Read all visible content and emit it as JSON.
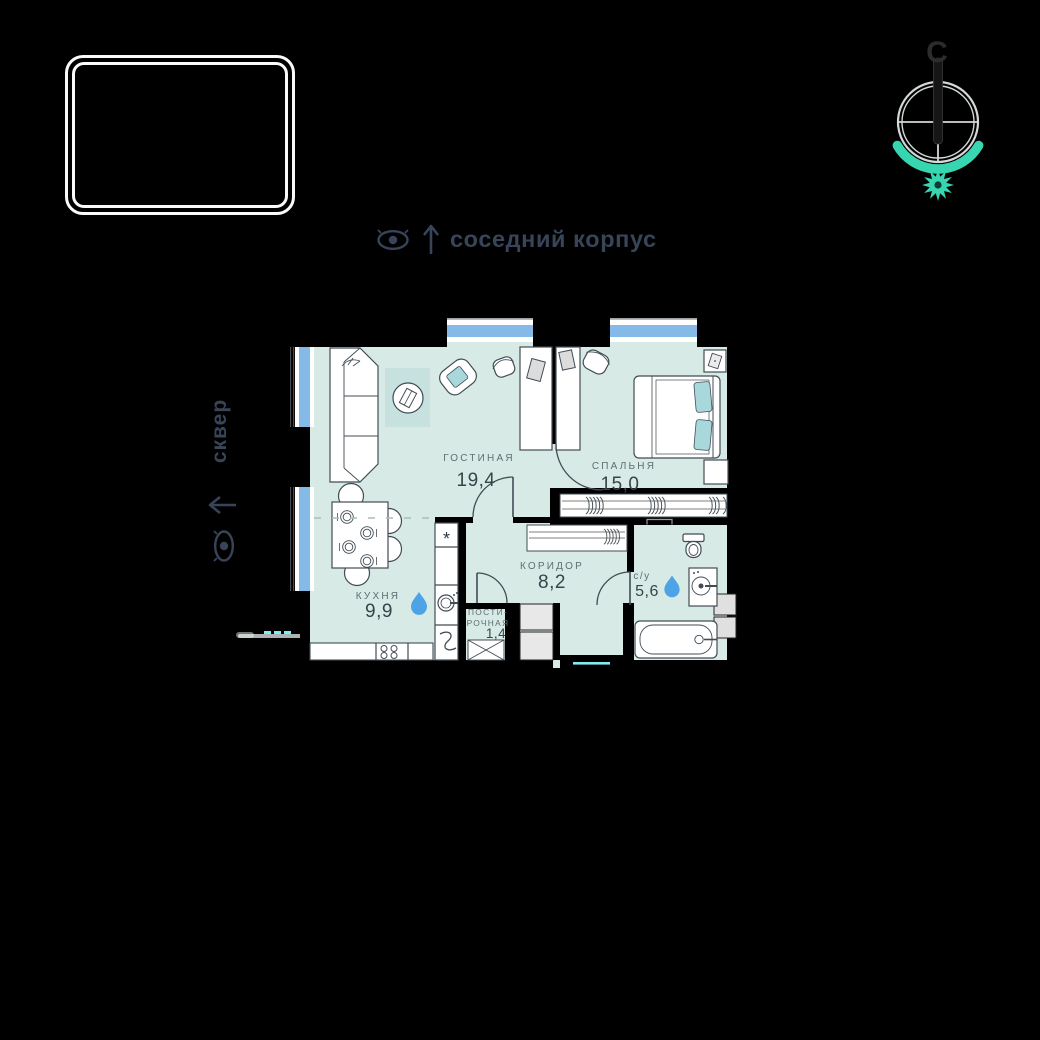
{
  "canvas": {
    "width": 1040,
    "height": 1040
  },
  "neighbor_note": {
    "label": "соседний корпус"
  },
  "park_note": {
    "label": "сквер"
  },
  "compass": {
    "north_letter": "С"
  },
  "plan": {
    "rooms": {
      "living": {
        "name": "ГОСТИНАЯ",
        "area": "19,4"
      },
      "bedroom": {
        "name": "СПАЛЬНЯ",
        "area": "15,0"
      },
      "kitchen": {
        "name": "КУХНЯ",
        "area": "9,9"
      },
      "corridor": {
        "name": "КОРИДОР",
        "area": "8,2"
      },
      "bathroom": {
        "name": "с/у",
        "area": "5,6"
      },
      "laundry": {
        "name_line1": "ПОСТИ-",
        "name_line2": "РОЧНАЯ",
        "area": "1,4"
      }
    },
    "symbols": {
      "fridge_star": "*"
    }
  },
  "colors": {
    "background": "#000000",
    "wall": "#000000",
    "floor": "#d8eae6",
    "rug": "#c6e1de",
    "window-glass": "#84b9e8",
    "furniture-stroke": "#424c54",
    "accent-teal": "#38d6b0",
    "pillow-teal": "#a8d8db",
    "water-drop": "#4da3e6",
    "entrance-cyan": "#7deef2",
    "room-label": "#5e6e73",
    "room-number": "#36454a",
    "note-text": "#384458"
  }
}
